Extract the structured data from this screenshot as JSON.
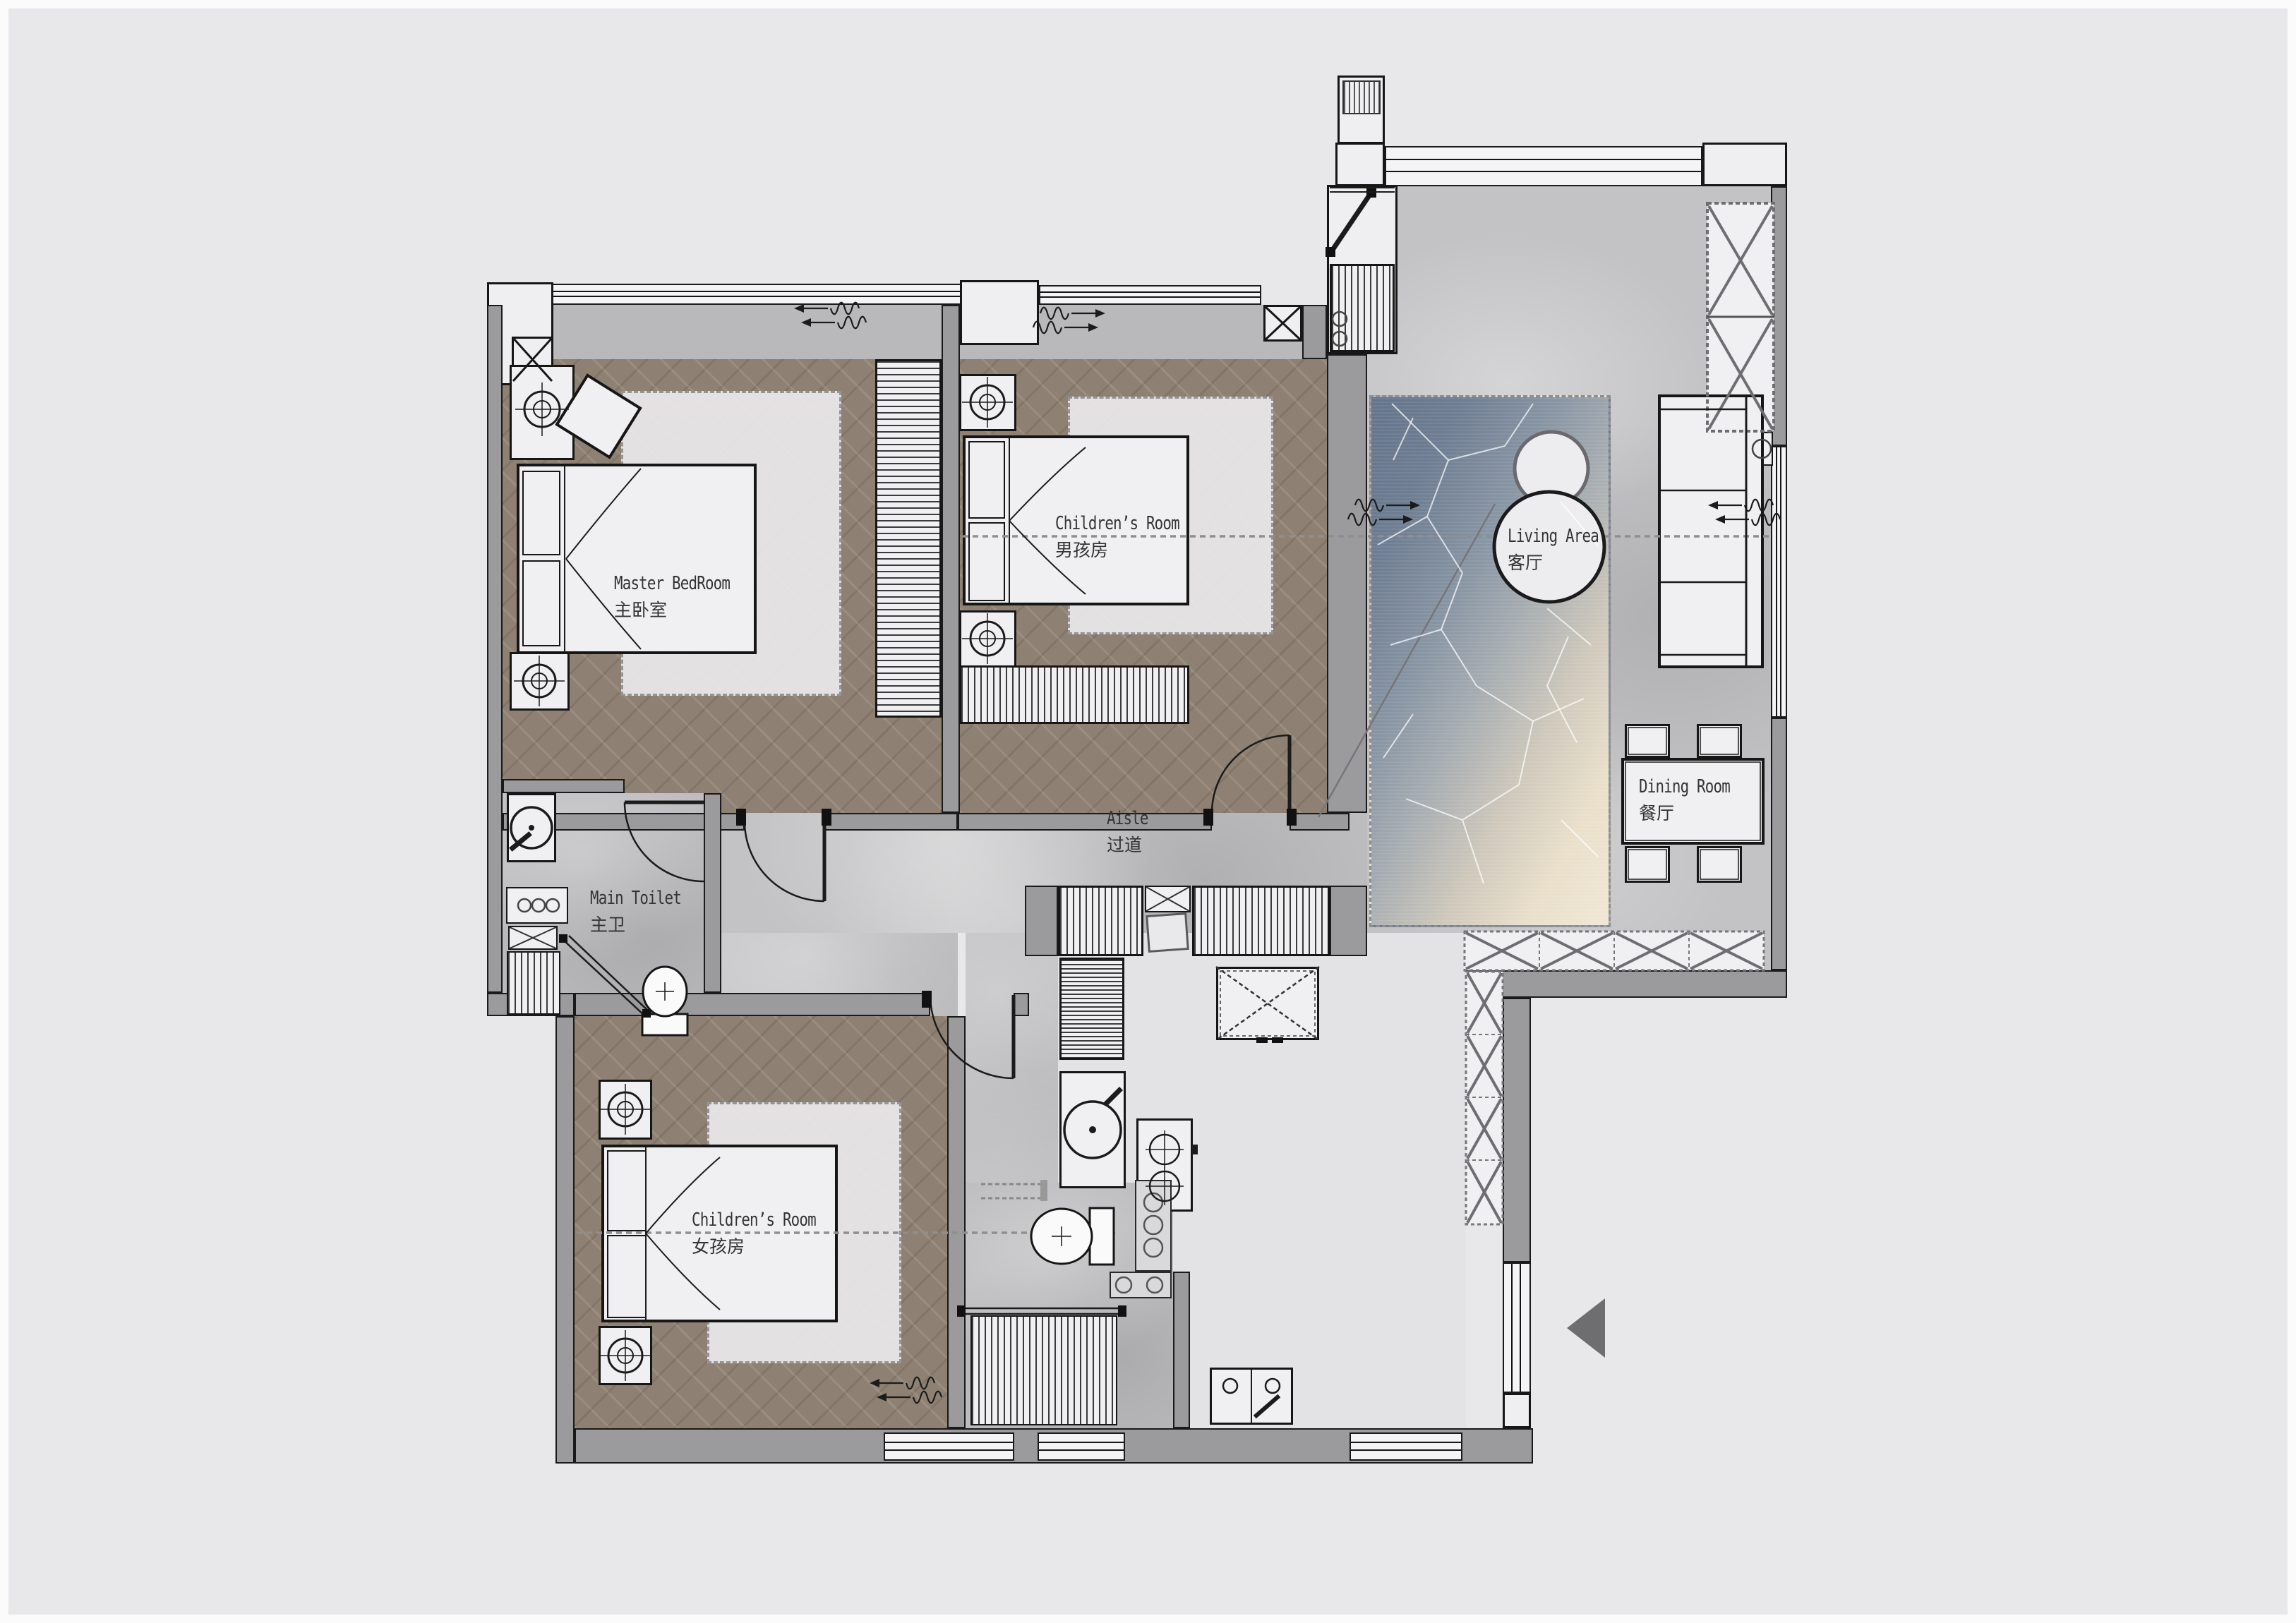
{
  "floor_plan": {
    "rooms": {
      "master": {
        "en": "Master BedRoom",
        "cn": "主卧室"
      },
      "boys": {
        "en": "Children’s Room",
        "cn": "男孩房"
      },
      "girls": {
        "en": "Children’s Room",
        "cn": "女孩房"
      },
      "toilet": {
        "en": "Main Toilet",
        "cn": "主卫"
      },
      "aisle": {
        "en": "Aisle",
        "cn": "过道"
      },
      "living": {
        "en": "Living Area",
        "cn": "客厅"
      },
      "dining": {
        "en": "Dining Room",
        "cn": "餐厅"
      }
    },
    "colors": {
      "background": "#e8e7e9",
      "wall": "#9b9a9c",
      "wood_floor": "#8e8173",
      "concrete_floor": "#c3c2c4",
      "kitchen_floor": "#e3e2e4",
      "rug_blue": "#64748a",
      "rug_cream": "#f0e7d4",
      "line": "#1b1b1b",
      "entry_arrow": "#6e6e70"
    },
    "symbols": [
      "bed",
      "nightstand-lamp",
      "wardrobe",
      "rug",
      "sofa",
      "coffee-tables",
      "dining-table",
      "chair",
      "stove",
      "kitchen-sink",
      "fridge",
      "washing-machine",
      "toilet",
      "shower",
      "door-swing",
      "curtain",
      "entry-arrow"
    ]
  }
}
